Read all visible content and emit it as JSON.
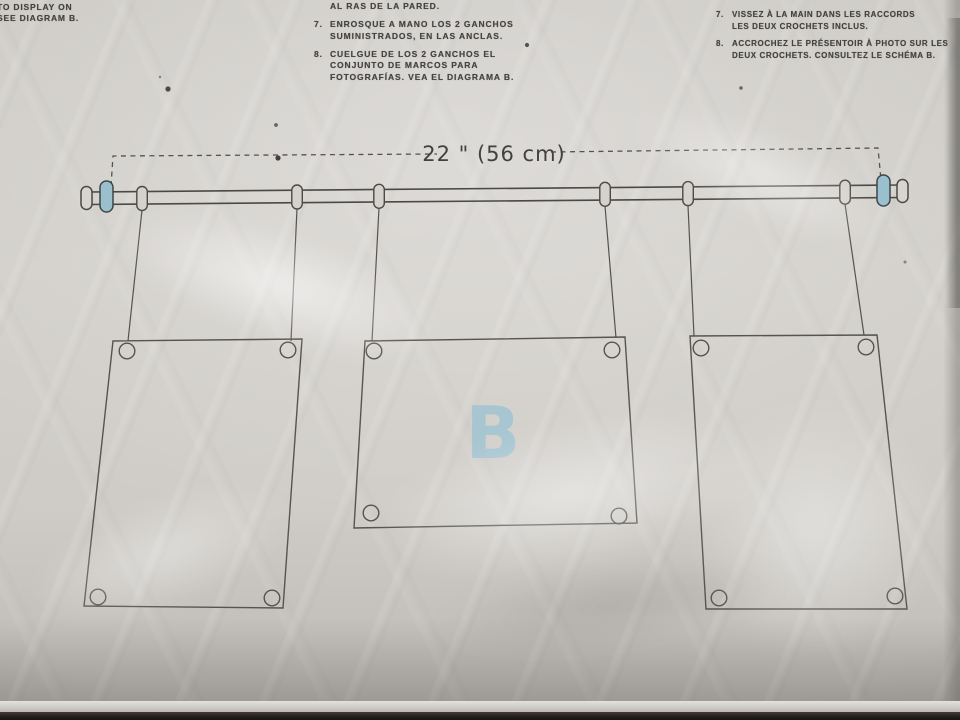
{
  "instructions": {
    "english": {
      "lines": [
        "TO DISPLAY ON",
        "SEE DIAGRAM B."
      ]
    },
    "spanish": {
      "continuation_line": "AL RAS DE LA PARED.",
      "items": [
        {
          "num": "7.",
          "lines": [
            "ENROSQUE A MANO LOS 2 GANCHOS",
            "SUMINISTRADOS, EN LAS ANCLAS."
          ]
        },
        {
          "num": "8.",
          "lines": [
            "CUELGUE DE LOS 2 GANCHOS EL",
            "CONJUNTO DE MARCOS PARA",
            "FOTOGRAFÍAS. VEA EL DIAGRAMA B."
          ]
        }
      ]
    },
    "french": {
      "items": [
        {
          "num": "7.",
          "lines": [
            "VISSEZ À LA MAIN DANS LES RACCORDS",
            "LES DEUX CROCHETS INCLUS."
          ]
        },
        {
          "num": "8.",
          "lines": [
            "ACCROCHEZ LE PRÉSENTOIR À PHOTO SUR LES",
            "DEUX CROCHETS. CONSULTEZ LE SCHÉMA B."
          ]
        }
      ]
    }
  },
  "diagram": {
    "dimension_label": "22 \" (56 cm)",
    "label": "B",
    "colors": {
      "hook_accent": "#9bc0cd",
      "line": "#514e4a",
      "diagram_label_blue": "#a4c5d2"
    }
  }
}
